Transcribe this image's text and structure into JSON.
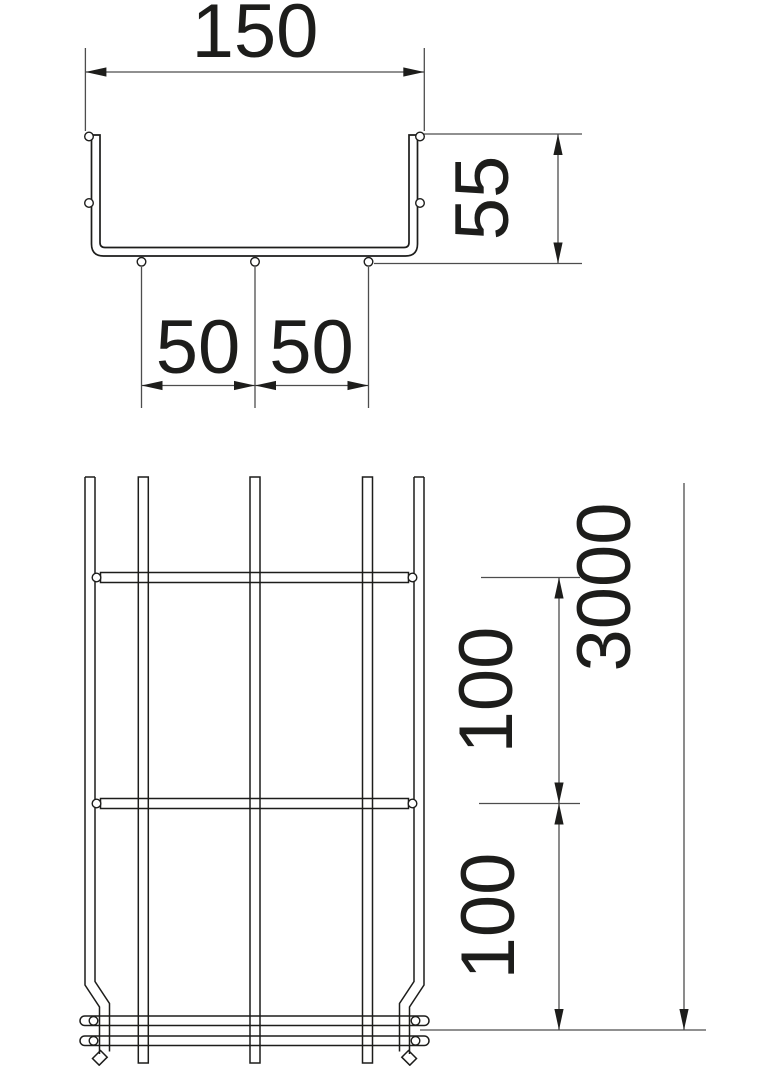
{
  "drawing": {
    "dimensions": {
      "top_width": "150",
      "side_height": "55",
      "bottom_wire_spacing_left": "50",
      "bottom_wire_spacing_right": "50",
      "mesh_pitch_upper": "100",
      "mesh_pitch_lower": "100",
      "length": "3000"
    },
    "colors": {
      "line": "#1d1d1b",
      "dim_line": "#4d4d4d",
      "background": "#ffffff"
    }
  }
}
